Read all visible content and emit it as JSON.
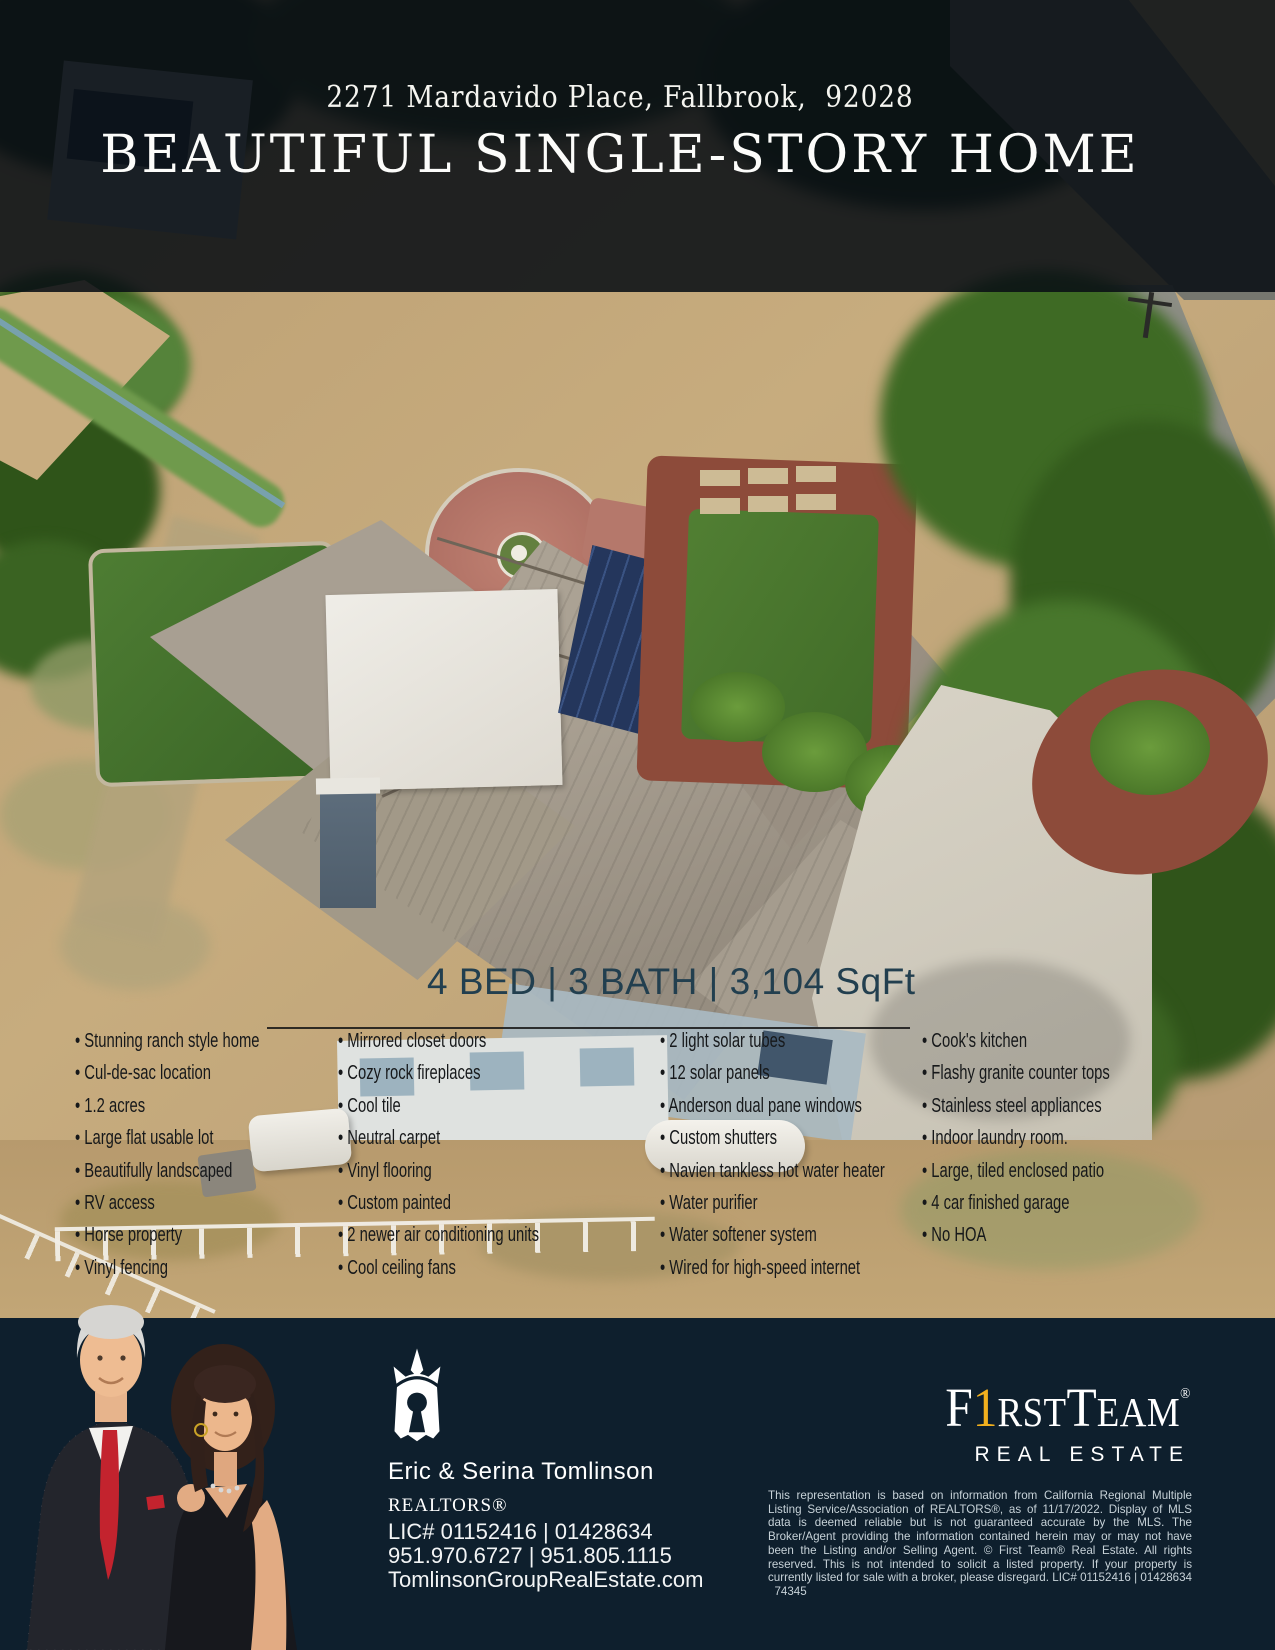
{
  "banner": {
    "address": "2271 Mardavido Place, Fallbrook,  92028",
    "title": "BEAUTIFUL SINGLE-STORY HOME"
  },
  "stats": {
    "line": "4 BED | 3 BATH | 3,104 SqFt"
  },
  "features": {
    "col1": [
      "Stunning ranch style home",
      "Cul-de-sac location",
      "1.2 acres",
      "Large flat usable lot",
      "Beautifully landscaped",
      "RV access",
      "Horse property",
      "Vinyl fencing"
    ],
    "col2": [
      "Mirrored closet doors",
      "Cozy rock fireplaces",
      "Cool tile",
      "Neutral carpet",
      "Vinyl flooring",
      "Custom painted",
      "2 newer air conditioning units",
      "Cool ceiling fans"
    ],
    "col3": [
      "2 light solar tubes",
      "12 solar panels",
      "Anderson dual pane windows",
      "Custom shutters",
      "Navien tankless hot water heater",
      "Water purifier",
      "Water softener system",
      "Wired for high-speed internet"
    ],
    "col4": [
      "Cook's kitchen",
      "Flashy granite counter tops",
      "Stainless steel appliances",
      "Indoor laundry room.",
      "Large, tiled enclosed patio",
      "4 car finished garage",
      "No HOA"
    ]
  },
  "footer": {
    "agents": {
      "name": "Eric & Serina Tomlinson",
      "title": "REALTORS®",
      "license": "LIC# 01152416 | 01428634",
      "phones": "951.970.6727 | 951.805.1115",
      "website": "TomlinsonGroupRealEstate.com"
    },
    "brand": {
      "part_f": "F",
      "part_one": "1",
      "part_rst": "RST",
      "part_t": "T",
      "part_eam": "EAM",
      "reg": "®",
      "subtitle": "REAL ESTATE"
    },
    "disclaimer": "This representation is based on information from California Regional Multiple Listing Service/Association of REALTORS®, as of 11/17/2022. Display of MLS data is deemed reliable but is not guaranteed accurate by the MLS. The Broker/Agent providing the information contained herein may or may not have been the Listing and/or Selling Agent. © First Team® Real Estate. All rights reserved. This is not intended to solicit a listed property. If your property is currently listed for sale with a broker, please disregard. LIC# 01152416 | 01428634   74345"
  },
  "colors": {
    "footer_navy": "#0e1f2d",
    "banner_overlay": "rgba(9,15,20,0.88)",
    "gold": "#f2b01e",
    "stats_text": "#223f4f",
    "feature_text": "#16181a",
    "white": "#ffffff"
  }
}
